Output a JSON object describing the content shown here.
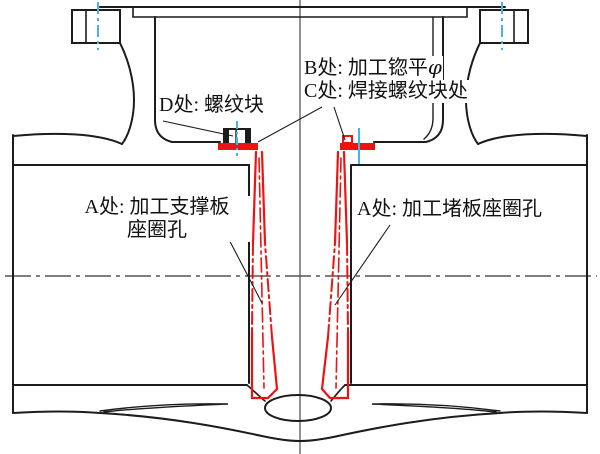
{
  "diagram": {
    "type": "engineering-cross-section",
    "labels": {
      "d": "D处: 螺纹块",
      "b": "B处: 加工锪平",
      "b_phi": "φ",
      "c": "C处: 焊接螺纹块处",
      "a_left_line1": "A处: 加工支撑板",
      "a_left_line2": "座圈孔",
      "a_right": "A处: 加工堵板座圈孔"
    },
    "colors": {
      "outline_black": "#1c1c1c",
      "highlight_red": "#ee1313",
      "centerline_blue": "#45b3e6",
      "axis_gray": "#787878",
      "background": "#ffffff"
    }
  }
}
